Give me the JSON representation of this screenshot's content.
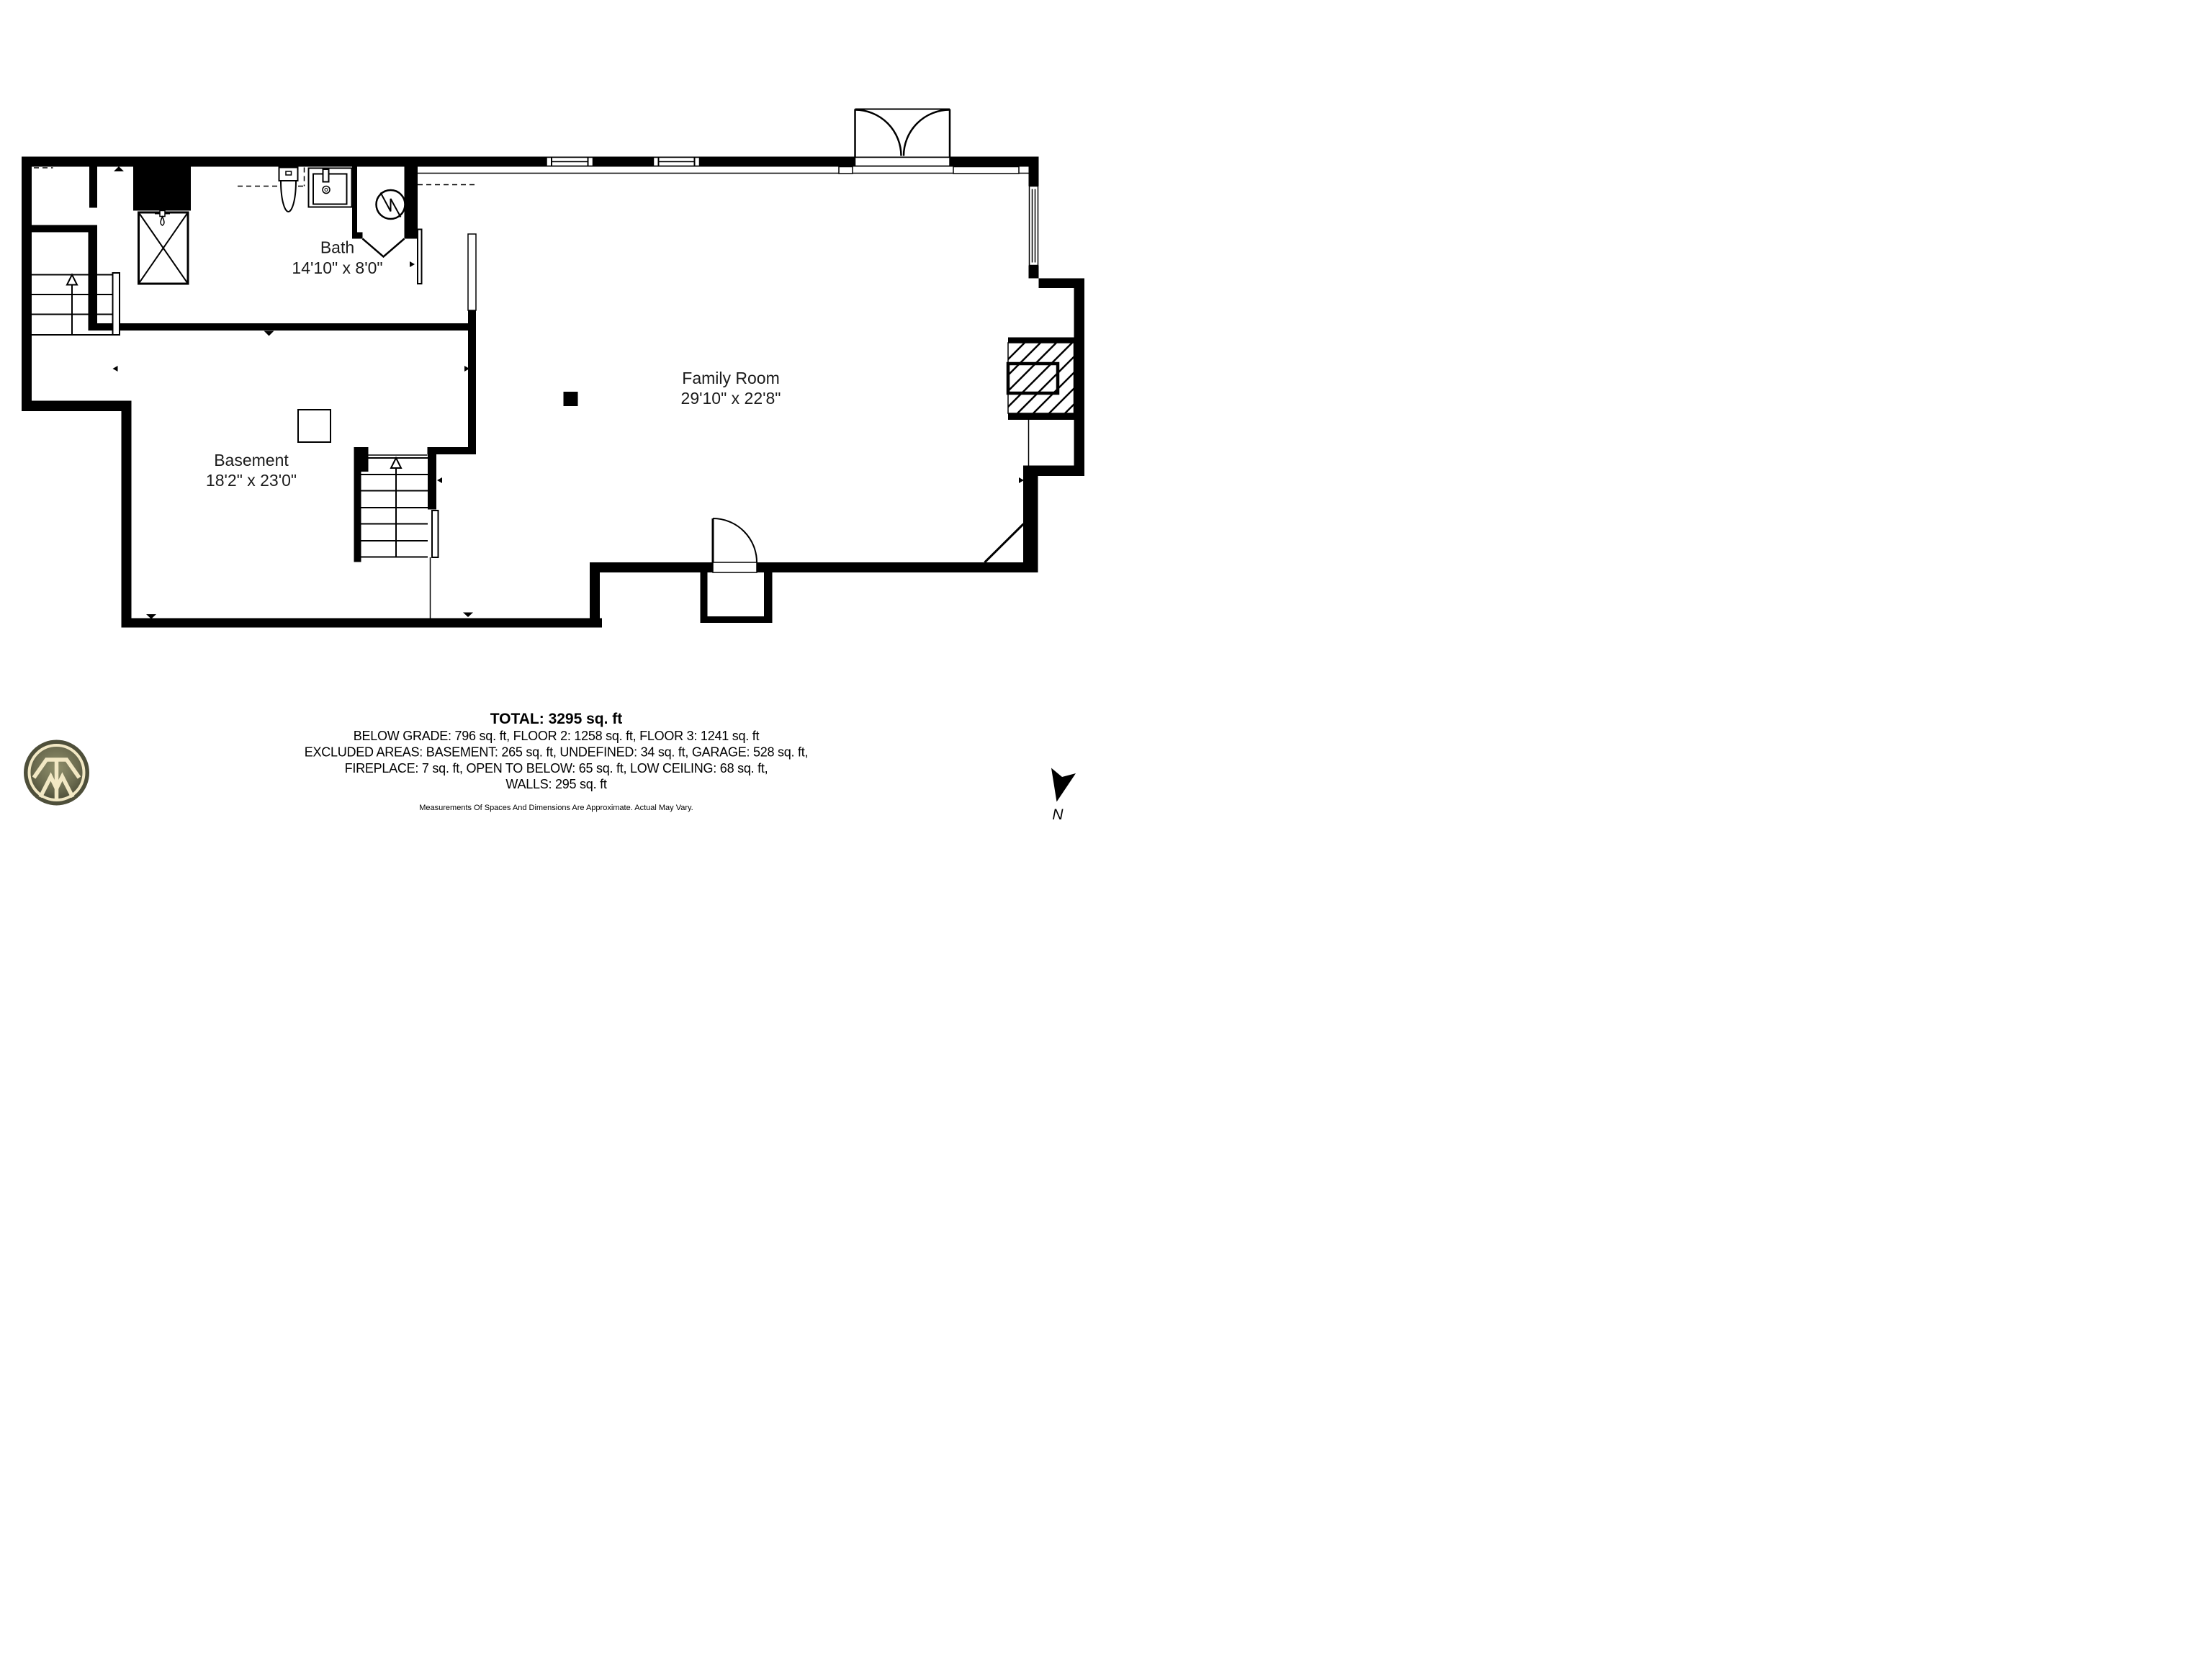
{
  "page": {
    "background": "#ffffff"
  },
  "rooms": [
    {
      "name": "Bath",
      "dimensions": "14'10\" x 8'0\""
    },
    {
      "name": "Family Room",
      "dimensions": "29'10\" x 22'8\""
    },
    {
      "name": "Basement",
      "dimensions": "18'2\" x 23'0\""
    }
  ],
  "summary": {
    "total": "TOTAL: 3295 sq. ft",
    "line_below_grade": "BELOW GRADE: 796 sq. ft, FLOOR 2: 1258 sq. ft, FLOOR 3: 1241 sq. ft",
    "line_excluded": "EXCLUDED AREAS: BASEMENT: 265 sq. ft, UNDEFINED: 34 sq. ft, GARAGE: 528 sq. ft,",
    "line_features": "FIREPLACE: 7 sq. ft, OPEN TO BELOW: 65 sq. ft, LOW CEILING: 68 sq. ft,",
    "line_walls": "WALLS: 295 sq. ft",
    "disclaimer": "Measurements Of Spaces And Dimensions Are Approximate. Actual May Vary."
  },
  "compass": {
    "label": "N"
  },
  "logo": {
    "ring_color": "#4e4f3a",
    "inner_dark": "#3c3d2c",
    "inner_light": "#90906c",
    "mark_color": "#f2e8c4"
  },
  "icons": {
    "toilet-icon": "toilet plan symbol",
    "sink-icon": "vanity sink plan symbol",
    "shower-icon": "shower stall with X",
    "water-heater-icon": "circle with zigzag",
    "stairs-up-icon": "stair treads with up arrow",
    "door-swing-icon": "quarter-circle door swing",
    "double-door-icon": "double door with two arcs",
    "window-icon": "wall window symbol",
    "fireplace-icon": "hatched chimney with firebox",
    "north-arrow-icon": "black compass dart",
    "brand-logo-icon": "circular TM emblem"
  }
}
